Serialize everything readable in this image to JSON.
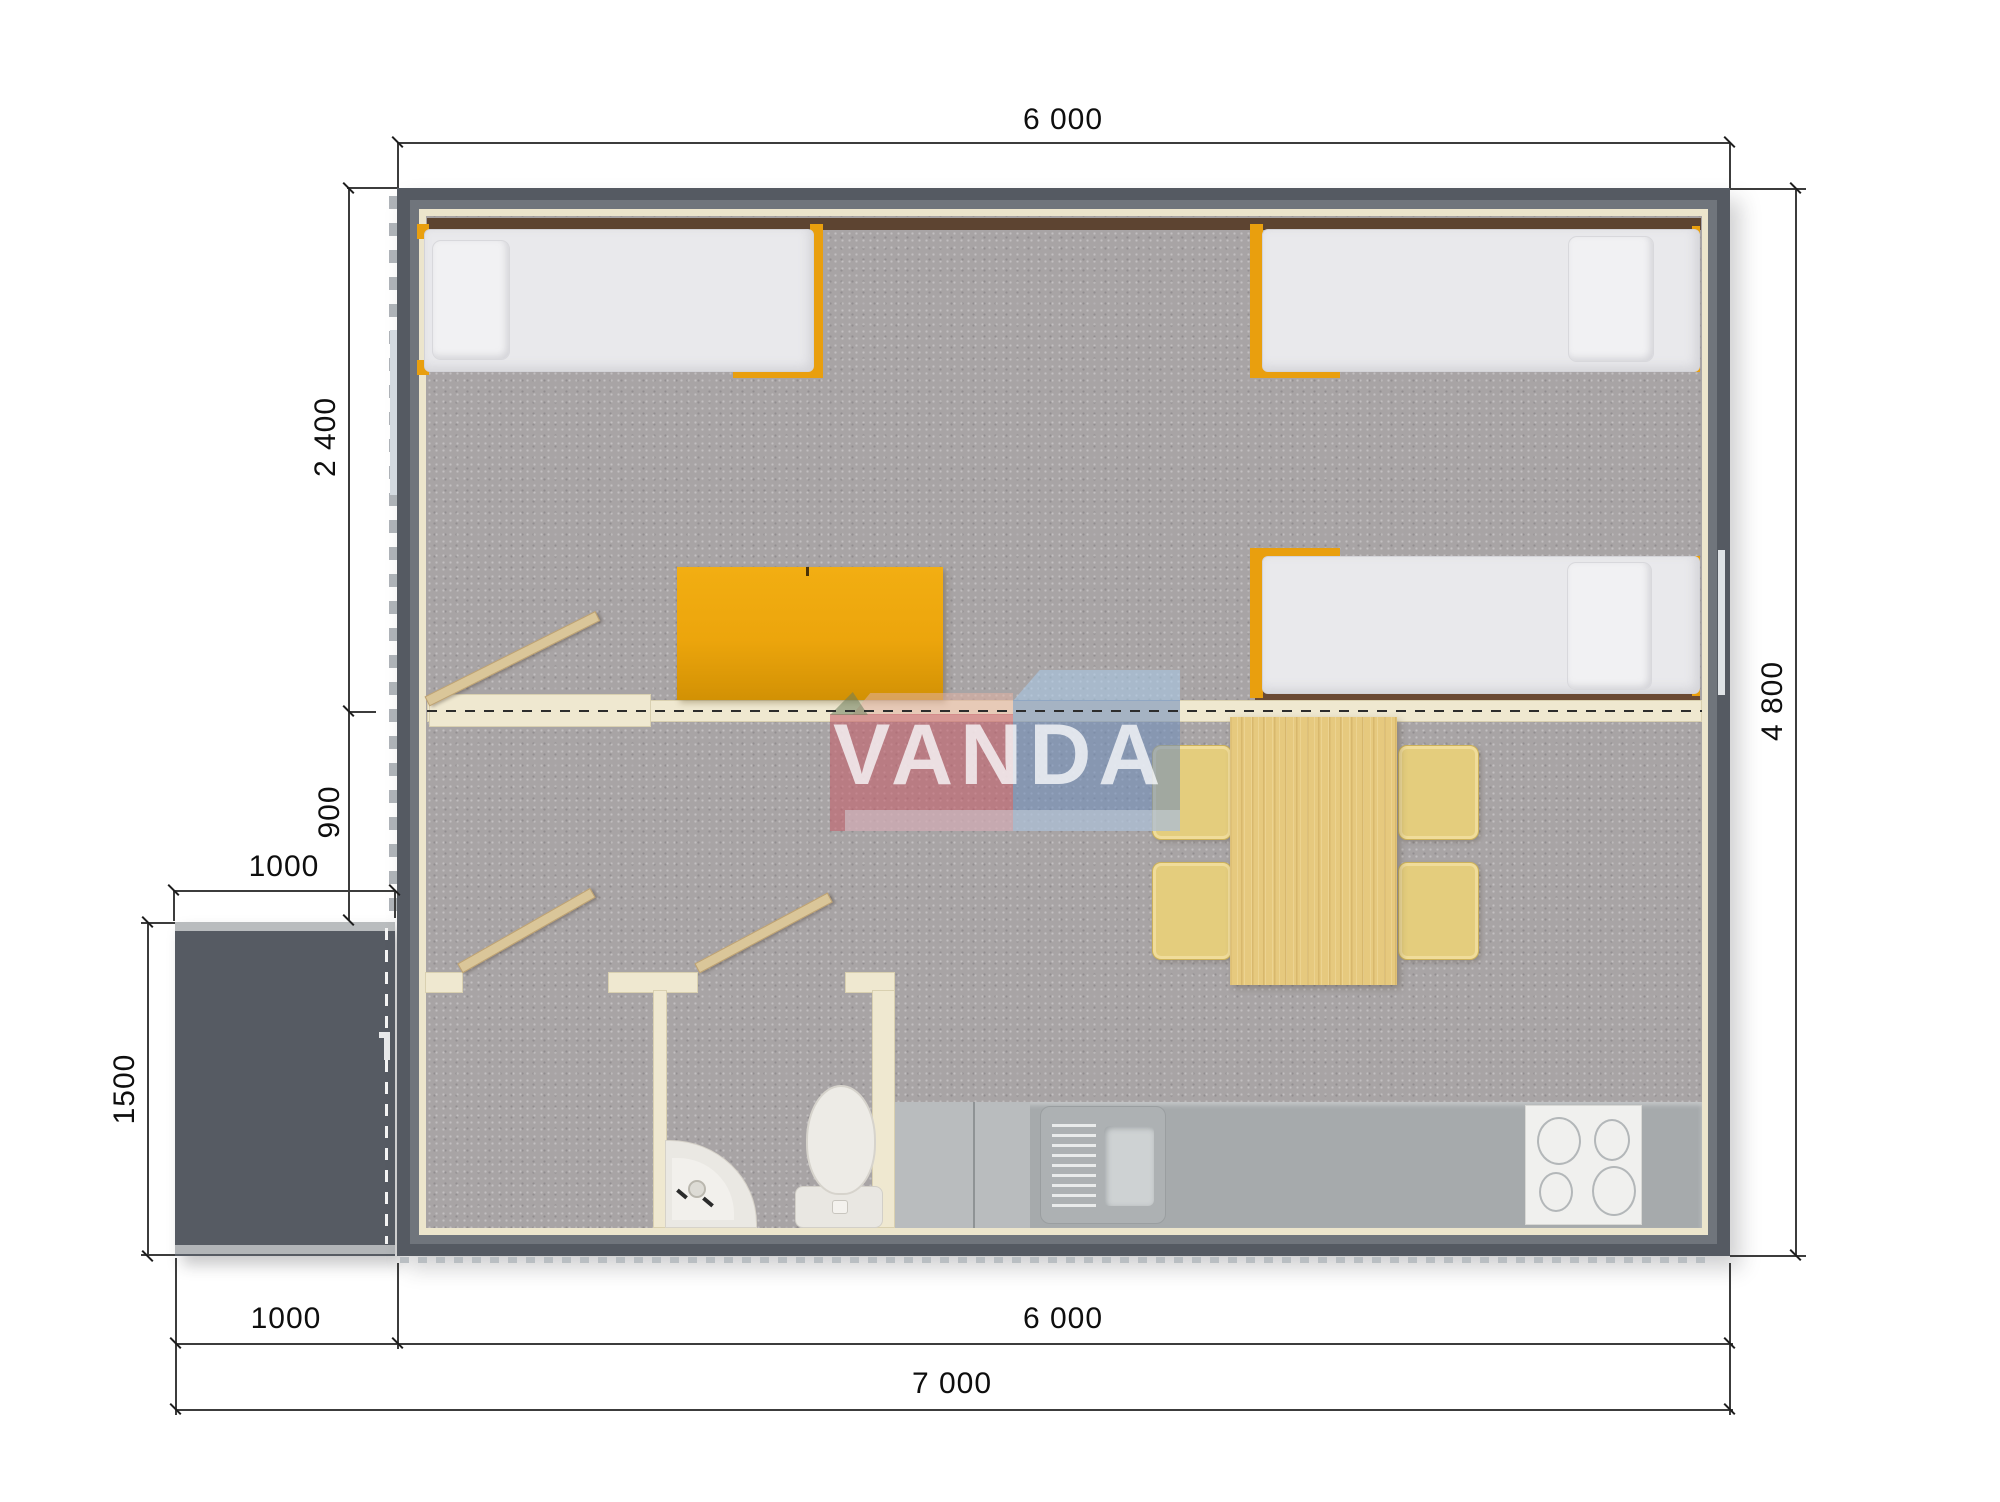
{
  "watermark": {
    "text": "VANDA",
    "pink": "#c75f6b",
    "blue": "#7b9ac4"
  },
  "dimensions": {
    "top_width": "6 000",
    "side_total_depth": "4 800",
    "bedroom_depth": "2 400",
    "middle_zone_depth": "900",
    "porch_width_upper": "1000",
    "porch_depth": "1500",
    "bottom_porch_width": "1000",
    "bottom_house_width": "6 000",
    "bottom_total_width": "7 000"
  },
  "colors": {
    "wall": "#555a62",
    "wall_inner": "#70757c",
    "wall_lining": "#ece5cc",
    "floor": "#a8a4a5",
    "accent_orange": "#eca40c",
    "wood": "#e6c97e",
    "kitchen_counter": "#a6aaac",
    "porch": "#565b63",
    "headboard_strip": "#5d4431"
  }
}
